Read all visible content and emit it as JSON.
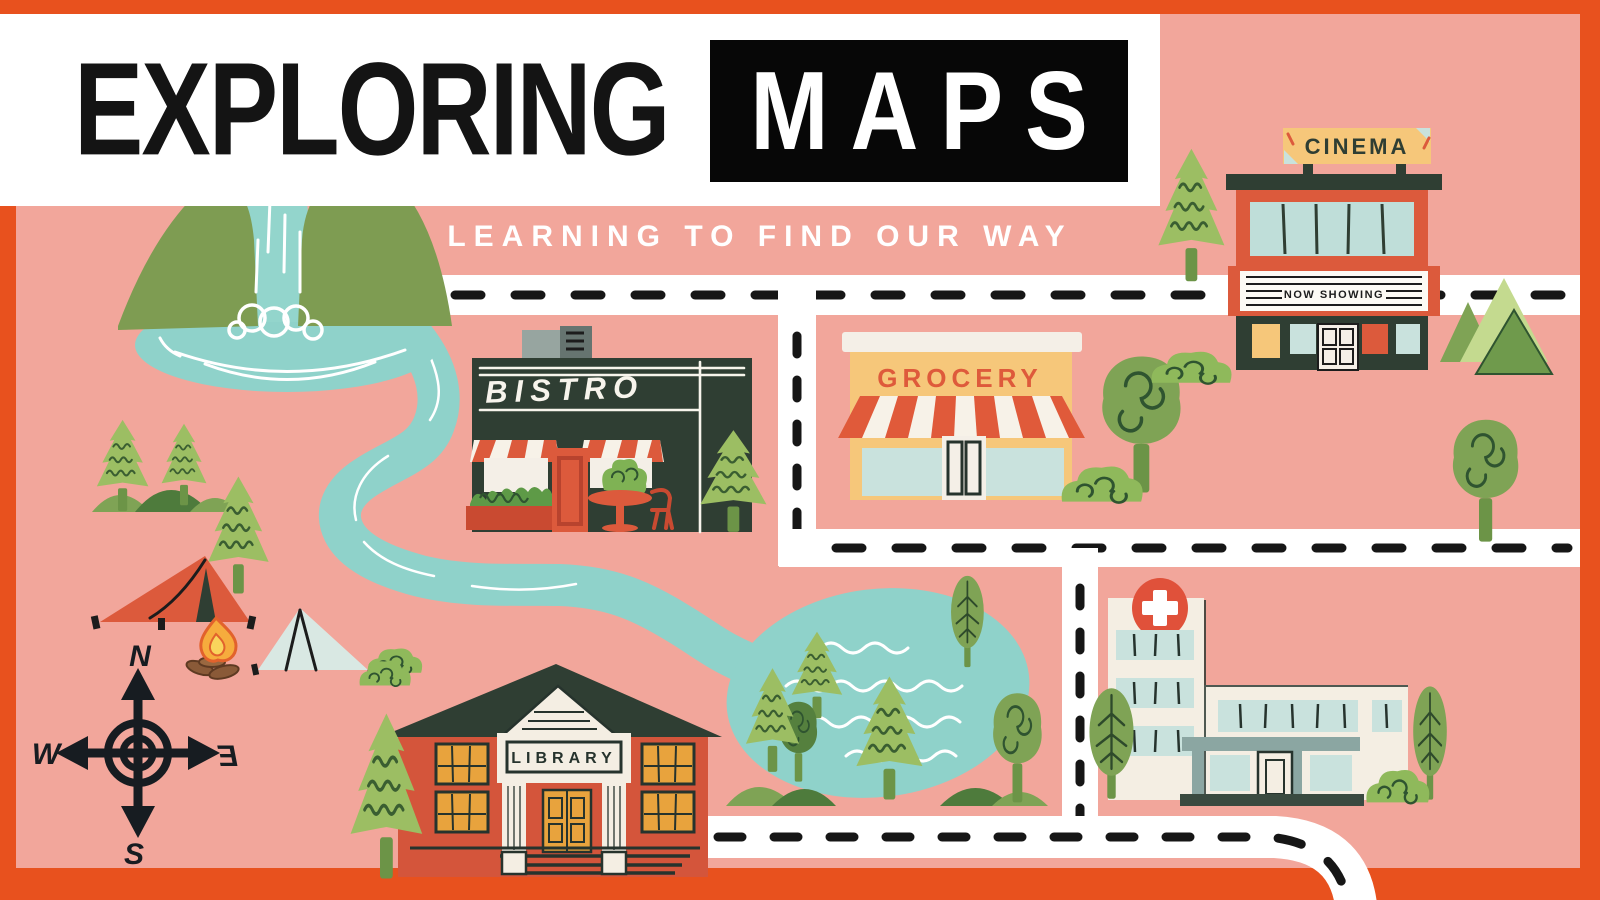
{
  "poster": {
    "title_main": "EXPLORING",
    "title_highlight": "MAPS",
    "subtitle": "LEARNING TO FIND OUR WAY"
  },
  "places": {
    "cinema": {
      "sign": "CINEMA",
      "marquee": "NOW SHOWING"
    },
    "grocery": {
      "sign": "GROCERY"
    },
    "bistro": {
      "sign": "BISTRO"
    },
    "library": {
      "sign": "LIBRARY"
    }
  },
  "compass": {
    "north": "N",
    "west": "W",
    "east": "E",
    "south": "S"
  },
  "colors": {
    "frame_orange": "#E8511E",
    "map_pink": "#F2A69B",
    "water_teal": "#8FD2CA",
    "building_red": "#DC5A3C",
    "charcoal_green": "#2F3E33",
    "accent_yellow": "#F6C77A",
    "window_teal": "#C9E2DD",
    "cream": "#F4EEE3",
    "tree_green": "#7FA355",
    "pine_green": "#9CBE63",
    "road_white": "#FFFFFF",
    "title_black": "#0A0A0A"
  }
}
